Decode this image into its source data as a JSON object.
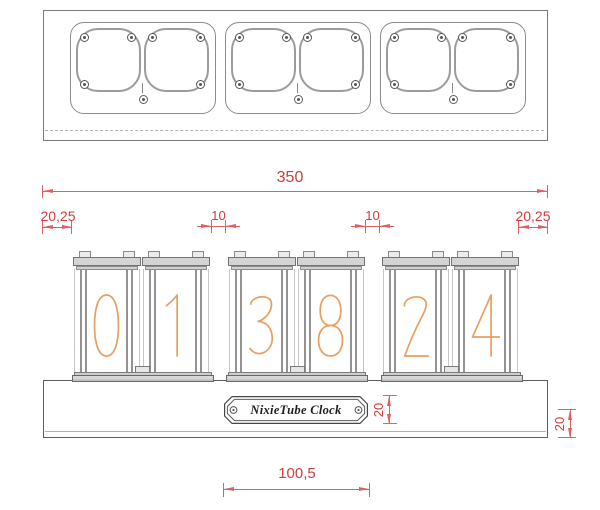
{
  "colors": {
    "dimension_text": "#d13b3b",
    "dimension_line": "#e06060",
    "digit_stroke": "#e8a061",
    "outline_gray": "#7a7a7a"
  },
  "top_view": {
    "module_count": 3,
    "sockets_per_module": 2
  },
  "front_view": {
    "digits": [
      "0",
      "1",
      "3",
      "8",
      "2",
      "4"
    ],
    "plaque_label": "NixieTube Clock"
  },
  "dimensions": {
    "total_width": "350",
    "left_margin": "20,25",
    "gap_left": "10",
    "gap_right": "10",
    "right_margin": "20,25",
    "plaque_height": "20",
    "base_height": "20",
    "plaque_width": "100,5"
  }
}
